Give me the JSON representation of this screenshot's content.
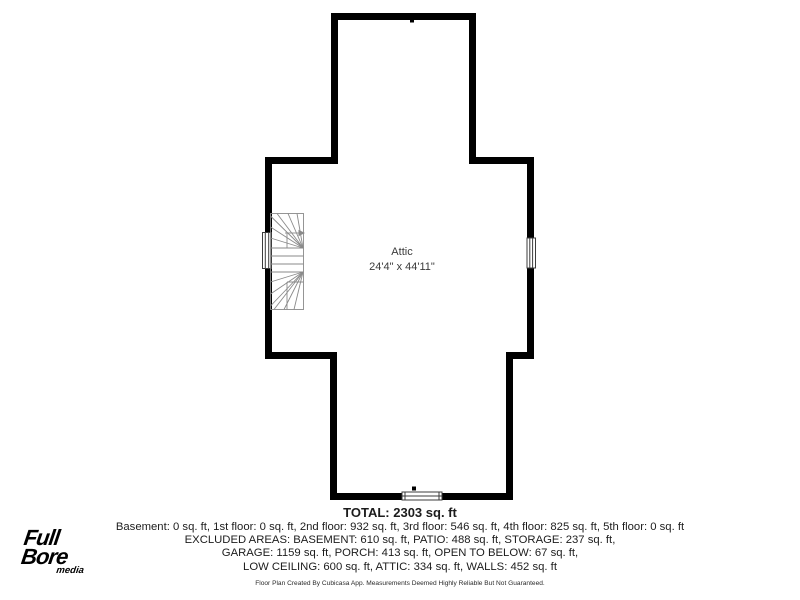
{
  "plan": {
    "room_name": "Attic",
    "room_dimensions": "24'4\" x 44'11\"",
    "icons": {
      "stairs": "winder-staircase-icon",
      "stair_arrow": "stair-direction-arrow-icon",
      "windows": "window-symbol"
    },
    "colors": {
      "wall": "#000000",
      "stair_lines": "#8a8a8a",
      "window_frame": "#3c3c3c",
      "text": "#1c1c1c"
    }
  },
  "summary": {
    "total": "TOTAL: 2303 sq. ft",
    "floors": "Basement: 0 sq. ft, 1st floor: 0 sq. ft, 2nd floor: 932 sq. ft, 3rd floor: 546 sq. ft, 4th floor: 825 sq. ft, 5th floor: 0 sq. ft",
    "excluded_line1": "EXCLUDED AREAS: BASEMENT: 610 sq. ft, PATIO: 488 sq. ft, STORAGE: 237 sq. ft,",
    "excluded_line2": "GARAGE: 1159 sq. ft, PORCH: 413 sq. ft, OPEN TO BELOW: 67 sq. ft,",
    "excluded_line3": "LOW CEILING: 600 sq. ft, ATTIC: 334 sq. ft, WALLS: 452 sq. ft",
    "disclaimer": "Floor Plan Created By Cubicasa App. Measurements Deemed Highly Reliable But Not Guaranteed."
  },
  "logo": {
    "line1": "Full",
    "line2": "Bore",
    "line3": "media"
  }
}
